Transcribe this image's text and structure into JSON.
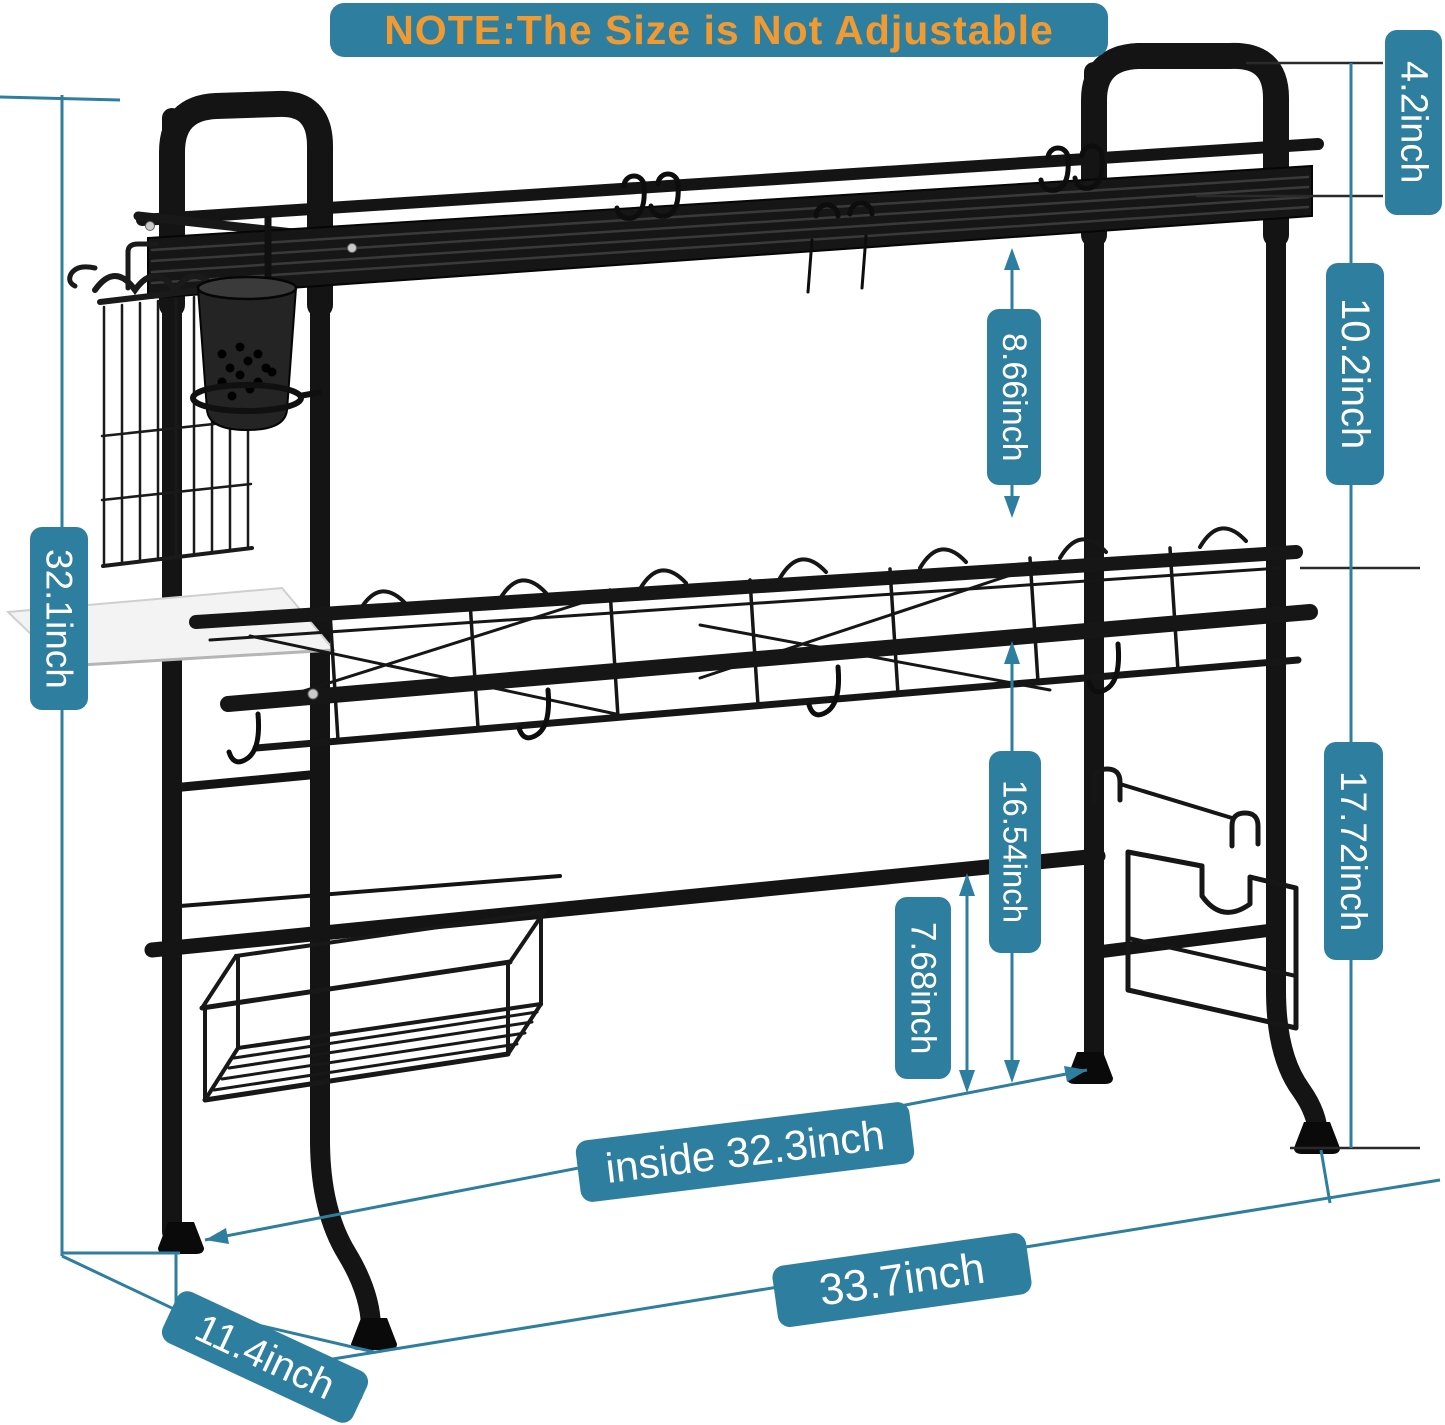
{
  "banner": {
    "text": "NOTE:The Size is Not Adjustable"
  },
  "dimensions": {
    "handle_height": "4.2inch",
    "top_to_middle_right": "10.2inch",
    "top_to_middle_arrow": "8.66inch",
    "overall_height": "32.1inch",
    "middle_to_counter": "16.54inch",
    "bar_to_counter": "7.68inch",
    "middle_height_right": "17.72inch",
    "inside_width": "inside 32.3inch",
    "overall_width": "33.7inch",
    "depth": "11.4inch"
  },
  "colors": {
    "label_bg": "#2E7E9F",
    "label_text": "#FFFFFF",
    "banner_text": "#F09A31",
    "line_teal": "#2E7E9F",
    "line_dark": "#2A2A2A",
    "rack": "#141414",
    "background": "#FFFFFF"
  },
  "illustration_parts": [
    "left-handle-loop",
    "right-handle-loop",
    "top-shelf",
    "s-hooks",
    "cutlery-cup",
    "side-wire-basket",
    "drain-tray",
    "middle-dish-basket",
    "cross-bar",
    "bottom-wire-basket",
    "board-holder",
    "rubber-feet"
  ]
}
